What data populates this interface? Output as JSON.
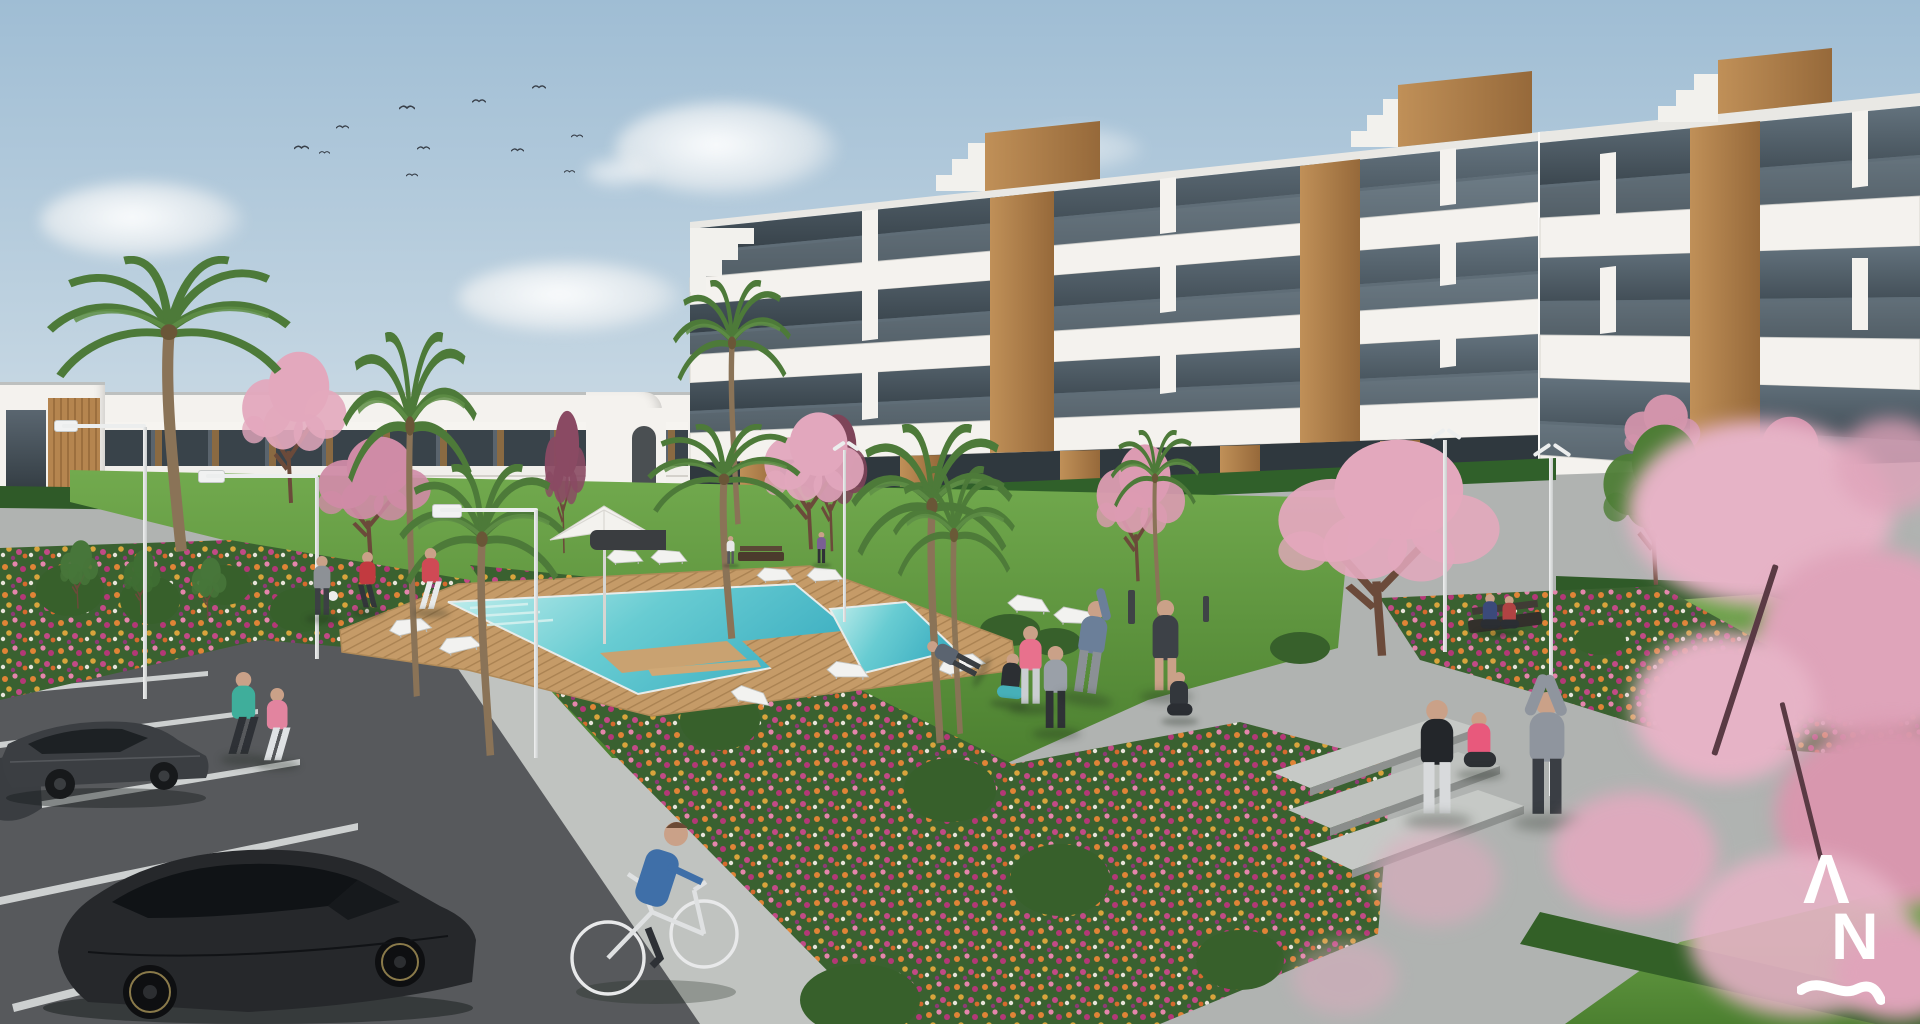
{
  "meta": {
    "title": "Residential complex exterior render",
    "type": "architectural 3D visualization, daytime"
  },
  "logo": {
    "mark_top": "Λ",
    "mark_bottom": "N",
    "mark_wave": "~",
    "color": "#ffffff"
  },
  "palette": {
    "sky-top": "#9fbdd4",
    "sky-mid": "#c9d9e4",
    "sky-horizon": "#eef1f1",
    "cloud": "#f7f4f1",
    "building-white": "#f4f2ee",
    "building-shade": "#dddad4",
    "glass-dark": "#333d44",
    "glass-light": "#71828d",
    "wood": "#b5854f",
    "wood-dark": "#8f6a3c",
    "hedge": "#2f5a28",
    "grass-light": "#6fa84b",
    "grass-dark": "#4c8030",
    "flower-base": "#3a6130",
    "flower-orange": "#e08436",
    "flower-pink": "#e585ac",
    "flower-magenta": "#b43777",
    "flower-yellow": "#d8a43c",
    "blossom": "#e3a8bd",
    "blossom-deep": "#cf8ba6",
    "pool-shallow": "#c4efed",
    "pool-deep": "#3fb0c2",
    "deck-wood": "#c59b68",
    "deck-wood-dark": "#a57f4f",
    "plaza": "#b0b3b1",
    "path": "#c0c3c0",
    "asphalt": "#57595c",
    "car-dark": "#26282b",
    "lamp-white": "#eceeee",
    "skin": "#caa188"
  },
  "scene": {
    "sky": {
      "clouds": 5,
      "birds": 11
    },
    "buildings": {
      "left": {
        "storeys": 2,
        "style": "white terraced apartments, wood slat panels, tinted glazing"
      },
      "right": {
        "storeys": 3,
        "style": "white apartment block, glass balconies, wood piers, rooftop stair volumes"
      }
    },
    "amenities": {
      "pool": {
        "shape": "two connected basins, wooden deck, in-water platform",
        "loungers": 10,
        "umbrellas": 1,
        "benches": 2
      },
      "street_lamps": 6,
      "bollards": 2,
      "parking": {
        "cars": 3,
        "marked_bays": true
      },
      "flower_beds": 5,
      "steps": 3
    },
    "vegetation": {
      "palm_trees": 8,
      "blossom_trees": 8,
      "purple_trees": 2,
      "green_trees": 4,
      "hedges": 4
    },
    "people": [
      {
        "activity": "jogging on sidewalk",
        "top": "#3fae9b"
      },
      {
        "activity": "jogging on sidewalk",
        "top": "#e2849f"
      },
      {
        "activity": "jogging on pool deck",
        "top": "#cf4a55"
      },
      {
        "activity": "carrying ball on deck",
        "top": "#8d9196"
      },
      {
        "activity": "leg stretch on deck",
        "top": "#c23a40"
      },
      {
        "activity": "walking near pool bench",
        "top": "#7a5f94"
      },
      {
        "activity": "standing by pool bench",
        "top": "#e6e7e8"
      },
      {
        "activity": "lounging on sunbed",
        "top": "#5b6470"
      },
      {
        "activity": "squat exercise on lawn",
        "top": "#2c2f33"
      },
      {
        "activity": "standing, sports top",
        "top": "#e8718d"
      },
      {
        "activity": "warm-up, hood up",
        "top": "#9aa0a8"
      },
      {
        "activity": "side stretch, arm raised",
        "top": "#6b7f99"
      },
      {
        "activity": "standing, shorts",
        "top": "#3d4147"
      },
      {
        "activity": "seated cross-legged on lawn",
        "top": "#33373c"
      },
      {
        "activity": "standing, track pants",
        "top": "#23262a"
      },
      {
        "activity": "seated cross-legged on steps",
        "top": "#e8597c"
      },
      {
        "activity": "overhead stretch",
        "top": "#8f959e"
      },
      {
        "activity": "sitting on bench",
        "top": "#3b4a7a"
      },
      {
        "activity": "sitting on bench",
        "top": "#b04343"
      },
      {
        "activity": "cycling",
        "top": "#3f6fa8"
      }
    ]
  }
}
